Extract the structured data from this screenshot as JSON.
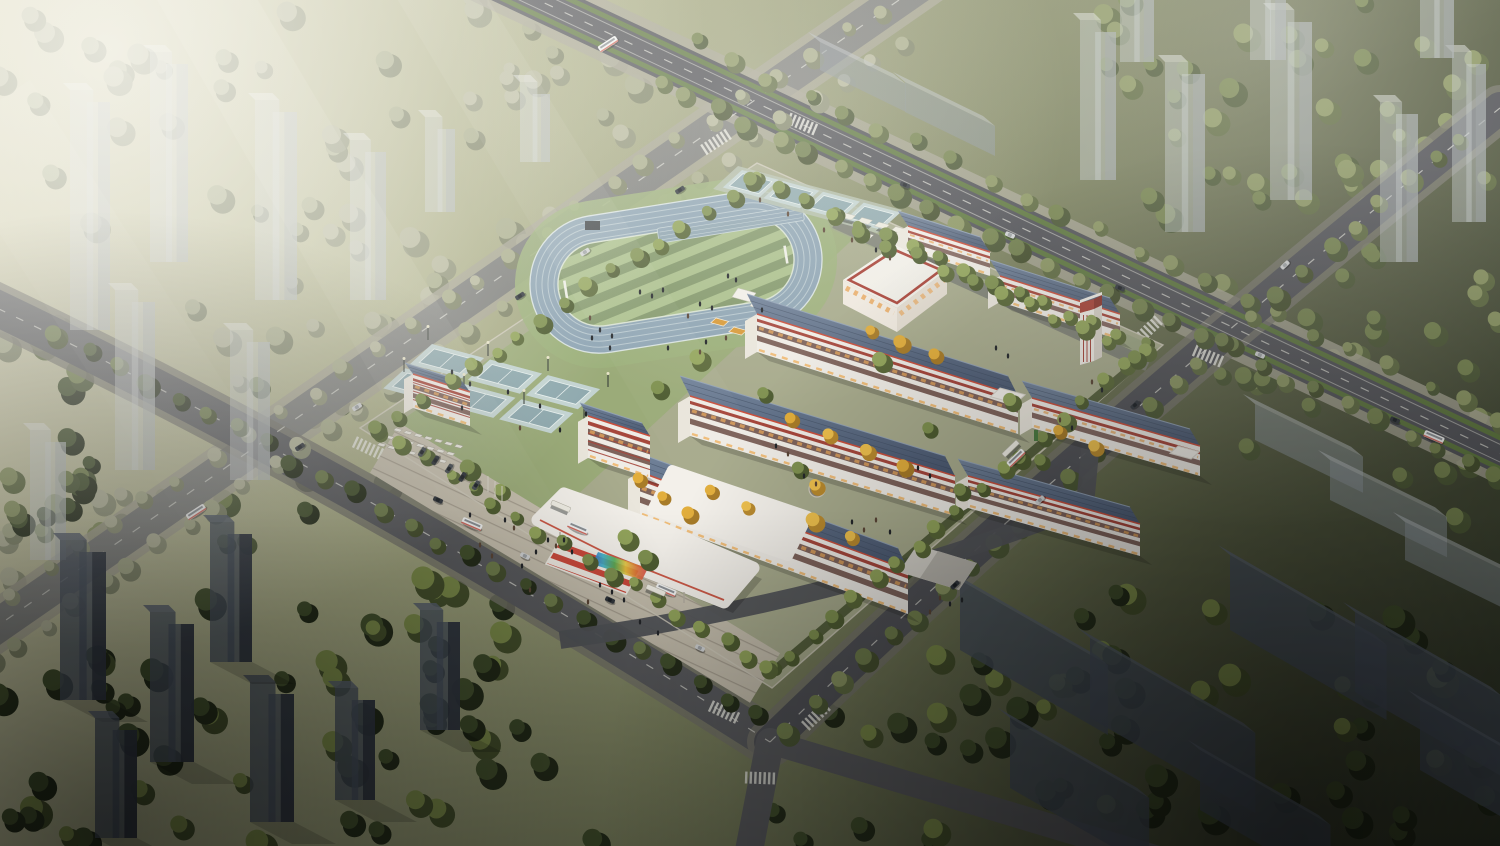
{
  "meta": {
    "title": "Aerial architectural rendering of a school campus at hazy dusk",
    "subject": "Bird's-eye render: school campus with oval running track, striped sports field, basketball courts, white classroom buildings with red trim and slate roofs, entrance canopies, surrounded by roads, trees and translucent city tower massings"
  },
  "palette": {
    "ground_tl": "#d6d2b4",
    "ground_a": "#abae88",
    "ground_b": "#818763",
    "ground_c": "#565c42",
    "ground_br": "#2f3527",
    "road": "#515257",
    "road_nw": "#7e7f7c",
    "road_sw": "#5b5c5f",
    "sidewalk": "#a6a493",
    "sidewalk_dark": "#77766c",
    "road_line": "#d8d8d0",
    "cycle_green": "#5f7c3a",
    "campus_base": "#a8ab8d",
    "campus_green": "#9aab78",
    "plaza": "#c6bfae",
    "plaza_line": "#a79f90",
    "inner_road": "#53555a",
    "inner_lane": "#7c7e74",
    "fence": "#cfcabb",
    "hedge": "#4c5834",
    "track": "#8fa5b4",
    "track_line": "#c9d7da",
    "track_edge": "#dfe8e8",
    "track_apron": "#9cb07b",
    "field_light": "#aabf8b",
    "field_dark": "#83986b",
    "field_edge": "#d8e2d2",
    "court_outer": "#c3d3d1",
    "court_inner": "#8fa9ae",
    "court_line": "#e9f1ef",
    "court_apron": "#b5bfae",
    "roof_top": "#72839a",
    "roof_bottom": "#4a5870",
    "roof_seam": "#3d4a5e",
    "roof_ridge": "#93a3b8",
    "roof_trim": "#c8503e",
    "facade": "#efece6",
    "facade_end": "#eae6dc",
    "facade_red": "#a6473c",
    "window_band": "#6e5048",
    "window_glow": "#e8a75c",
    "glow": "#f0b568",
    "gym_roof": "#eceae3",
    "gym_roof_in": "#f4f2eb",
    "gym_band": "#a84338",
    "gym_face": "#efe9df",
    "gym_face2": "#e3dcd0",
    "canopy": "#f3f0ea",
    "canopy_shade": "#d9d5cc",
    "tent": "#d6d3cb",
    "tent_dark": "#b9b6ae",
    "stand_orange": "#d89b3a",
    "tower_body_l": "#ced3d2",
    "tower_side_l": "#aab0af",
    "tower_top_l": "#e3e6e3",
    "tower_body_d": "#47505c",
    "tower_side_d": "#2e343d",
    "tower_top_d": "#59626e",
    "shadow": "#1a1d18",
    "people": "#23262a",
    "car_dark": "#32373d",
    "car_light": "#d2d4d5",
    "bus": "#f2f3f2",
    "haze": "#fbfaf4",
    "rainbow": [
      "#3a6fd8",
      "#3ab0c8",
      "#52b058",
      "#e8c83c",
      "#e07838",
      "#d84848"
    ],
    "tree_pale_top": "#b6b79c",
    "tree_pale_base": "#8f9378",
    "tree_olive_top": "#8a9562",
    "tree_olive_base": "#5f6b42",
    "tree_dark_top": "#44522e",
    "tree_dark_base": "#262e1b",
    "tree_bright_top": "#93a55c",
    "tree_bright_base": "#5a6838",
    "tree_street_top": "#6f7d4c",
    "tree_street_base": "#46502f",
    "tree_gold_top": "#eec04d",
    "tree_gold_base": "#b98a2e"
  }
}
